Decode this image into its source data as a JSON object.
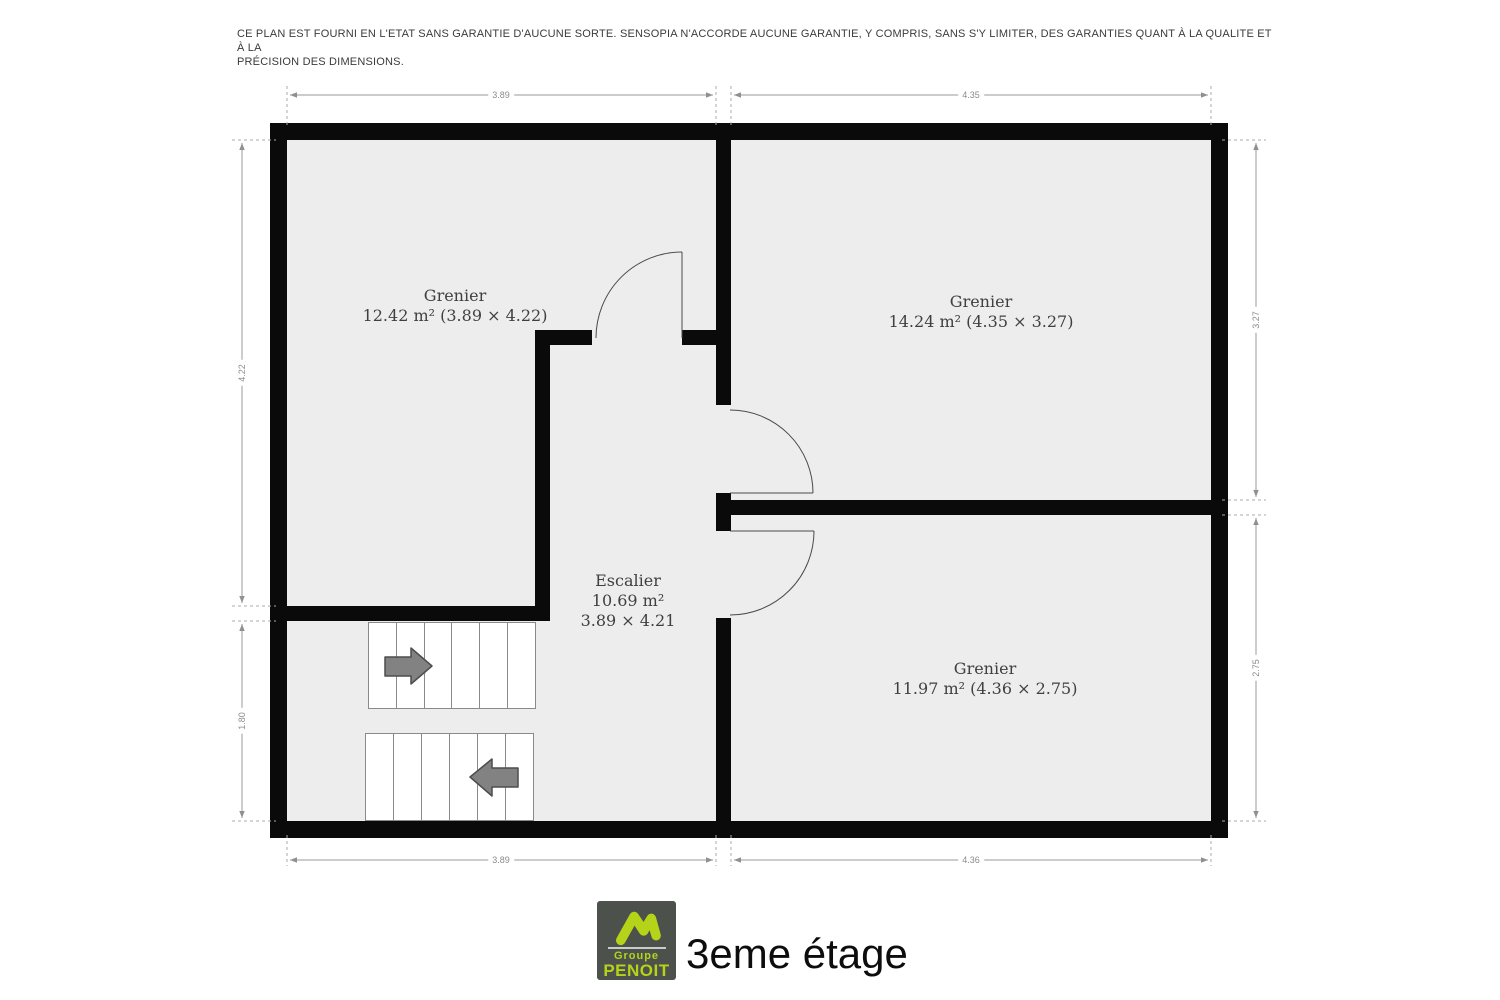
{
  "disclaimer": {
    "line1": "CE PLAN EST FOURNI EN L'ETAT SANS GARANTIE D'AUCUNE SORTE. SENSOPIA N'ACCORDE AUCUNE GARANTIE, Y COMPRIS, SANS S'Y LIMITER, DES GARANTIES QUANT À LA QUALITE ET À LA",
    "line2": "PRÉCISION DES DIMENSIONS."
  },
  "rooms": {
    "grenier_nw": {
      "name": "Grenier",
      "details": "12.42 m² (3.89 × 4.22)"
    },
    "grenier_ne": {
      "name": "Grenier",
      "details": "14.24 m² (4.35 × 3.27)"
    },
    "escalier": {
      "name": "Escalier",
      "area": "10.69 m²",
      "size": "3.89 × 4.21"
    },
    "grenier_se": {
      "name": "Grenier",
      "details": "11.97 m² (4.36 × 2.75)"
    }
  },
  "dims": {
    "top_left": "3.89",
    "top_right": "4.35",
    "bottom_left": "3.89",
    "bottom_right": "4.36",
    "left_upper": "4.22",
    "left_lower": "1.80",
    "right_upper": "3.27",
    "right_lower": "2.75"
  },
  "footer": {
    "logo_line1": "Groupe",
    "logo_line2": "PENOIT",
    "floor_title": "3eme étage"
  },
  "icons": {
    "logo_mark": "mountain-roof-icon",
    "stairs_up": "arrow-right-icon",
    "stairs_down": "arrow-left-icon"
  },
  "colors": {
    "wall": "#0a0a0a",
    "room_fill": "#ededee",
    "dimension_gray": "#8b8b8b",
    "logo_bg": "#4c514c",
    "logo_accent": "#b5d318",
    "arrow_gray": "#828282"
  }
}
